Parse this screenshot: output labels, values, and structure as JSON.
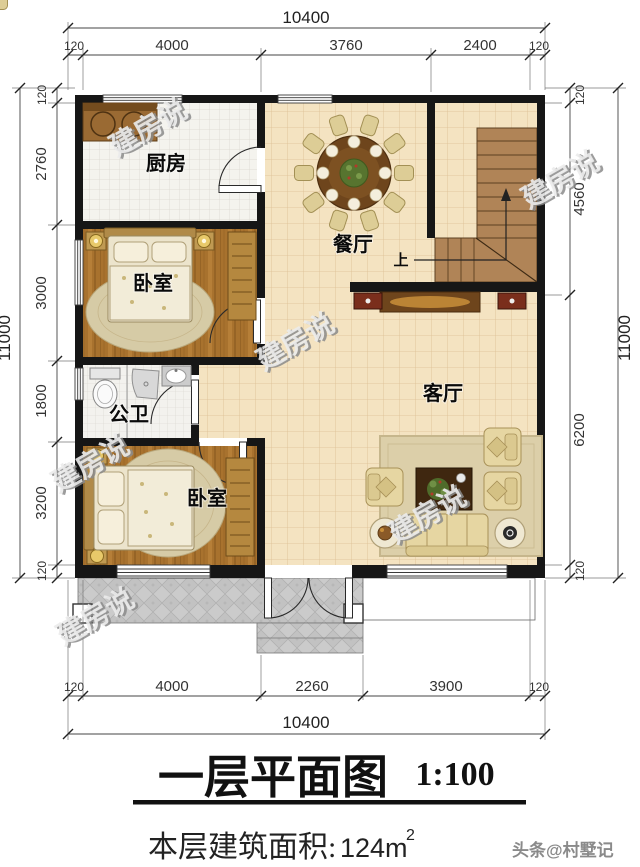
{
  "meta": {
    "title_text": "一层平面图",
    "scale_text": "1:100",
    "area_label": "本层建筑面积:",
    "area_value": "124m",
    "area_sup": "2",
    "credit": "头条@村墅记"
  },
  "watermark": {
    "text": "建房说"
  },
  "rooms": {
    "kitchen": "厨房",
    "dining": "餐厅",
    "bedroom1": "卧室",
    "bathroom": "公卫",
    "bedroom2": "卧室",
    "living": "客厅",
    "stair_up": "上"
  },
  "dims": {
    "top_total": "10400",
    "top": [
      "120",
      "4000",
      "3760",
      "2400",
      "120"
    ],
    "bottom": [
      "120",
      "4000",
      "2260",
      "3900",
      "120"
    ],
    "bottom_total": "10400",
    "left": [
      "120",
      "2760",
      "3000",
      "1800",
      "3200",
      "120"
    ],
    "left_total": "11000",
    "right": [
      "120",
      "4560",
      "6200",
      "120"
    ],
    "right_total": "11000"
  },
  "colors": {
    "wall": "#161616",
    "floor_tile": "#f4e3c1",
    "wood": "#a8722e",
    "stair": "#b08457",
    "porch": "#cbcbcb"
  }
}
